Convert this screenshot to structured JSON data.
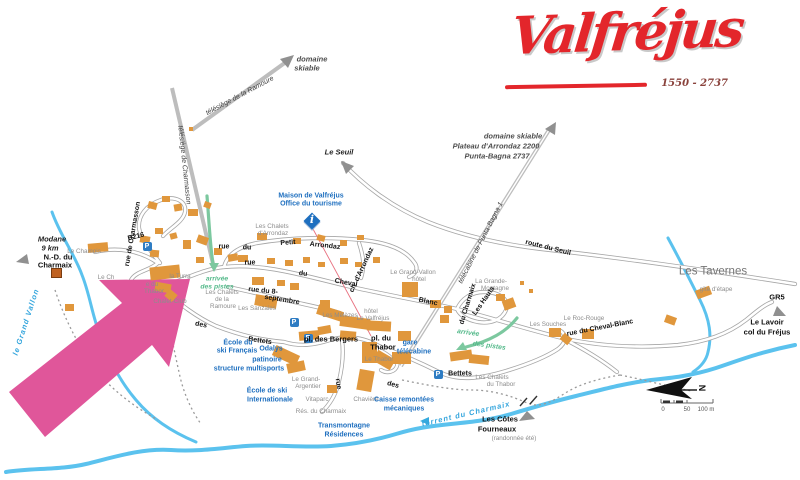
{
  "logo": {
    "name": "Valfréjus",
    "elevation": "1550 - 2737"
  },
  "icons": {
    "parking_letter": "P",
    "info_letter": "i"
  },
  "colors": {
    "highlight": "#e0569a",
    "building": "#e0973c",
    "river": "#5bc2ee",
    "road": "#a6a6a6",
    "lift": "#bdbdbd",
    "green": "#7cc89f",
    "brand": "#e3262b"
  },
  "highlight_arrow": {
    "points": "190,279 99,280 122,303 9,392 45,437 152,345 169,367"
  },
  "parkings": [
    {
      "x": 147,
      "y": 246
    },
    {
      "x": 294,
      "y": 322
    },
    {
      "x": 308,
      "y": 338
    },
    {
      "x": 438,
      "y": 374
    }
  ],
  "map_labels": [
    {
      "t": "télésiège de Charmasson",
      "x": 184,
      "y": 165,
      "cls": "lift",
      "r": 84
    },
    {
      "t": "télésiège de la Ramoure",
      "x": 240,
      "y": 96,
      "cls": "lift",
      "r": -28
    },
    {
      "t": "télécabine de Punta-Bagna 1",
      "x": 481,
      "y": 243,
      "cls": "lift",
      "r": -63
    },
    {
      "t": "domaine",
      "x": 312,
      "y": 59,
      "cls": "dom"
    },
    {
      "t": "skiable",
      "x": 307,
      "y": 68,
      "cls": "dom"
    },
    {
      "t": "domaine skiable",
      "x": 513,
      "y": 136,
      "cls": "dom"
    },
    {
      "t": "Plateau d'Arrondaz 2200",
      "x": 496,
      "y": 146,
      "cls": "dom"
    },
    {
      "t": "Punta-Bagna 2737",
      "x": 497,
      "y": 156,
      "cls": "dom"
    },
    {
      "t": "Le Seuil",
      "x": 339,
      "y": 152,
      "cls": "dest"
    },
    {
      "t": "Modane",
      "x": 52,
      "y": 239,
      "cls": "dest"
    },
    {
      "t": "9 km",
      "x": 50,
      "y": 248,
      "cls": "dest"
    },
    {
      "t": "N.-D. du",
      "x": 58,
      "y": 257,
      "cls": "pl"
    },
    {
      "t": "Charmaix",
      "x": 55,
      "y": 265,
      "cls": "pl"
    },
    {
      "t": "D216",
      "x": 136,
      "y": 237,
      "cls": "st",
      "r": -14
    },
    {
      "t": "rue de Charmasson",
      "x": 133,
      "y": 234,
      "cls": "st",
      "r": -80
    },
    {
      "t": "Le Chamois",
      "x": 84,
      "y": 252,
      "cls": "loc"
    },
    {
      "t": "le Grand Vallon",
      "x": 26,
      "y": 322,
      "cls": "riv",
      "r": -72
    },
    {
      "t": "Maison de Valfréjus",
      "x": 311,
      "y": 196,
      "cls": "bl"
    },
    {
      "t": "Office du tourisme",
      "x": 311,
      "y": 204,
      "cls": "bl"
    },
    {
      "t": "Les Chalets",
      "x": 272,
      "y": 227,
      "cls": "loc"
    },
    {
      "t": "d'Arrondaz",
      "x": 273,
      "y": 234,
      "cls": "loc"
    },
    {
      "t": "rue",
      "x": 224,
      "y": 247,
      "cls": "st"
    },
    {
      "t": "du",
      "x": 247,
      "y": 248,
      "cls": "st"
    },
    {
      "t": "Petit",
      "x": 288,
      "y": 243,
      "cls": "st",
      "r": -4
    },
    {
      "t": "Arrondaz",
      "x": 325,
      "y": 246,
      "cls": "st",
      "r": 6
    },
    {
      "t": "ch. d'Arrondaz",
      "x": 362,
      "y": 270,
      "cls": "st",
      "r": -65
    },
    {
      "t": "rue",
      "x": 250,
      "y": 263,
      "cls": "st"
    },
    {
      "t": "du",
      "x": 303,
      "y": 274,
      "cls": "st",
      "r": 6
    },
    {
      "t": "Cheval",
      "x": 346,
      "y": 283,
      "cls": "st",
      "r": 10
    },
    {
      "t": "Blanc",
      "x": 428,
      "y": 302,
      "cls": "st",
      "r": 12
    },
    {
      "t": "rue du 8-",
      "x": 263,
      "y": 291,
      "cls": "st",
      "r": 6
    },
    {
      "t": "septembre",
      "x": 282,
      "y": 300,
      "cls": "st",
      "r": 9
    },
    {
      "t": "Le Ch",
      "x": 106,
      "y": 278,
      "cls": "loc"
    },
    {
      "t": "la Turra",
      "x": 180,
      "y": 277,
      "cls": "loc"
    },
    {
      "t": "e du",
      "x": 152,
      "y": 285,
      "cls": "loc"
    },
    {
      "t": "Thabor",
      "x": 154,
      "y": 292,
      "cls": "loc"
    },
    {
      "t": "Chalet-Club",
      "x": 170,
      "y": 302,
      "cls": "loc"
    },
    {
      "t": "arrivée",
      "x": 217,
      "y": 280,
      "cls": "gr"
    },
    {
      "t": "des pistes",
      "x": 217,
      "y": 288,
      "cls": "gr"
    },
    {
      "t": "Les Chalets",
      "x": 222,
      "y": 293,
      "cls": "loc"
    },
    {
      "t": "de la",
      "x": 222,
      "y": 300,
      "cls": "loc"
    },
    {
      "t": "Ramoure",
      "x": 223,
      "y": 307,
      "cls": "loc"
    },
    {
      "t": "Les Sanzaies",
      "x": 257,
      "y": 309,
      "cls": "loc"
    },
    {
      "t": "des",
      "x": 201,
      "y": 325,
      "cls": "st",
      "r": 12
    },
    {
      "t": "Bettets",
      "x": 260,
      "y": 341,
      "cls": "st",
      "r": 8
    },
    {
      "t": "Les Mélèzes",
      "x": 340,
      "y": 316,
      "cls": "loc"
    },
    {
      "t": "hôtel",
      "x": 371,
      "y": 312,
      "cls": "loc"
    },
    {
      "t": "Le Valfréjus",
      "x": 373,
      "y": 319,
      "cls": "loc"
    },
    {
      "t": "Le Grand-Vallon",
      "x": 413,
      "y": 273,
      "cls": "loc"
    },
    {
      "t": "hôtel",
      "x": 419,
      "y": 280,
      "cls": "loc"
    },
    {
      "t": "La Grande-",
      "x": 491,
      "y": 282,
      "cls": "loc"
    },
    {
      "t": "Montagne",
      "x": 495,
      "y": 289,
      "cls": "loc"
    },
    {
      "t": "Les Hauts",
      "x": 484,
      "y": 301,
      "cls": "st",
      "r": -55
    },
    {
      "t": "du Charmaix",
      "x": 468,
      "y": 304,
      "cls": "st",
      "r": -73
    },
    {
      "t": "Les Souches",
      "x": 548,
      "y": 325,
      "cls": "loc"
    },
    {
      "t": "Le Roc-Rouge",
      "x": 584,
      "y": 319,
      "cls": "loc"
    },
    {
      "t": "rue du Cheval-Blanc",
      "x": 600,
      "y": 328,
      "cls": "st",
      "r": -11
    },
    {
      "t": "route du Seuil",
      "x": 548,
      "y": 248,
      "cls": "st",
      "r": 14
    },
    {
      "t": "Les Tavernes",
      "x": 713,
      "y": 272,
      "cls": "big"
    },
    {
      "t": "gîte d'étape",
      "x": 716,
      "y": 290,
      "cls": "loc"
    },
    {
      "t": "GR5",
      "x": 777,
      "y": 297,
      "cls": "pl"
    },
    {
      "t": "Le Lavoir",
      "x": 767,
      "y": 322,
      "cls": "pl"
    },
    {
      "t": "col du Fréjus",
      "x": 767,
      "y": 332,
      "cls": "pl"
    },
    {
      "t": "arrivée",
      "x": 468,
      "y": 334,
      "cls": "gr",
      "r": 8
    },
    {
      "t": "des pistes",
      "x": 489,
      "y": 347,
      "cls": "gr",
      "r": 8
    },
    {
      "t": "pl. des Bergers",
      "x": 331,
      "y": 339,
      "cls": "pl"
    },
    {
      "t": "pl. du",
      "x": 381,
      "y": 338,
      "cls": "pl"
    },
    {
      "t": "Thabor",
      "x": 383,
      "y": 347,
      "cls": "pl"
    },
    {
      "t": "Le Thabor",
      "x": 379,
      "y": 360,
      "cls": "loc"
    },
    {
      "t": "gare",
      "x": 410,
      "y": 343,
      "cls": "bl"
    },
    {
      "t": "télécabine",
      "x": 414,
      "y": 352,
      "cls": "bl"
    },
    {
      "t": "École du",
      "x": 238,
      "y": 343,
      "cls": "bl"
    },
    {
      "t": "ski Français",
      "x": 237,
      "y": 351,
      "cls": "bl"
    },
    {
      "t": "Odalys",
      "x": 271,
      "y": 349,
      "cls": "bl"
    },
    {
      "t": "patinoire",
      "x": 267,
      "y": 360,
      "cls": "bl"
    },
    {
      "t": "structure multisports",
      "x": 249,
      "y": 369,
      "cls": "bl"
    },
    {
      "t": "École de ski",
      "x": 267,
      "y": 391,
      "cls": "bl"
    },
    {
      "t": "Internationale",
      "x": 270,
      "y": 400,
      "cls": "bl"
    },
    {
      "t": "Le Grand-",
      "x": 306,
      "y": 380,
      "cls": "loc"
    },
    {
      "t": "Argentier",
      "x": 308,
      "y": 387,
      "cls": "loc"
    },
    {
      "t": "Vitaparc",
      "x": 317,
      "y": 400,
      "cls": "loc"
    },
    {
      "t": "Rés. du Charmaix",
      "x": 321,
      "y": 412,
      "cls": "loc"
    },
    {
      "t": "Chavière",
      "x": 366,
      "y": 400,
      "cls": "loc"
    },
    {
      "t": "rue",
      "x": 338,
      "y": 384,
      "cls": "st",
      "r": 80
    },
    {
      "t": "des",
      "x": 393,
      "y": 385,
      "cls": "st",
      "r": 15
    },
    {
      "t": "Bettets",
      "x": 460,
      "y": 374,
      "cls": "st"
    },
    {
      "t": "Les Chalets",
      "x": 492,
      "y": 378,
      "cls": "loc"
    },
    {
      "t": "du Thabor",
      "x": 501,
      "y": 385,
      "cls": "loc"
    },
    {
      "t": "Caisse remontées",
      "x": 404,
      "y": 400,
      "cls": "bl"
    },
    {
      "t": "mécaniques",
      "x": 404,
      "y": 409,
      "cls": "bl"
    },
    {
      "t": "Transmontagne",
      "x": 344,
      "y": 426,
      "cls": "bl"
    },
    {
      "t": "Résidences",
      "x": 344,
      "y": 435,
      "cls": "bl"
    },
    {
      "t": "torrent du Charmaix",
      "x": 466,
      "y": 414,
      "cls": "riv",
      "r": -13
    },
    {
      "t": "Les Côtes",
      "x": 500,
      "y": 419,
      "cls": "pl"
    },
    {
      "t": "Fourneaux",
      "x": 497,
      "y": 429,
      "cls": "pl"
    },
    {
      "t": "(randonnée été)",
      "x": 514,
      "y": 439,
      "cls": "loc"
    },
    {
      "t": "N",
      "x": 703,
      "y": 388,
      "cls": "cn",
      "r": -90
    },
    {
      "t": "0",
      "x": 663,
      "y": 410,
      "cls": "sc"
    },
    {
      "t": "50",
      "x": 687,
      "y": 410,
      "cls": "sc"
    },
    {
      "t": "100 m",
      "x": 706,
      "y": 410,
      "cls": "sc"
    }
  ],
  "buildings": [
    {
      "x": 148,
      "y": 202,
      "w": 9,
      "h": 7,
      "r": 15
    },
    {
      "x": 162,
      "y": 196,
      "w": 8,
      "h": 6
    },
    {
      "x": 174,
      "y": 204,
      "w": 8,
      "h": 7,
      "r": -10
    },
    {
      "x": 188,
      "y": 209,
      "w": 10,
      "h": 7
    },
    {
      "x": 204,
      "y": 202,
      "w": 7,
      "h": 6,
      "r": 20
    },
    {
      "x": 88,
      "y": 243,
      "w": 20,
      "h": 9,
      "r": -5
    },
    {
      "x": 140,
      "y": 236,
      "w": 10,
      "h": 7,
      "r": 10
    },
    {
      "x": 155,
      "y": 228,
      "w": 8,
      "h": 6
    },
    {
      "x": 170,
      "y": 233,
      "w": 7,
      "h": 6,
      "r": -15
    },
    {
      "x": 150,
      "y": 250,
      "w": 9,
      "h": 7,
      "r": 5
    },
    {
      "x": 183,
      "y": 240,
      "w": 8,
      "h": 9
    },
    {
      "x": 197,
      "y": 236,
      "w": 11,
      "h": 8,
      "r": 20
    },
    {
      "x": 214,
      "y": 248,
      "w": 8,
      "h": 7
    },
    {
      "x": 196,
      "y": 257,
      "w": 8,
      "h": 6
    },
    {
      "x": 228,
      "y": 254,
      "w": 10,
      "h": 7,
      "r": -10
    },
    {
      "x": 150,
      "y": 266,
      "w": 30,
      "h": 13,
      "r": -6
    },
    {
      "x": 155,
      "y": 283,
      "w": 16,
      "h": 9,
      "r": 10
    },
    {
      "x": 166,
      "y": 291,
      "w": 10,
      "h": 9,
      "r": 40
    },
    {
      "x": 189,
      "y": 127,
      "w": 4,
      "h": 4
    },
    {
      "x": 257,
      "y": 233,
      "w": 10,
      "h": 7
    },
    {
      "x": 293,
      "y": 238,
      "w": 8,
      "h": 6
    },
    {
      "x": 317,
      "y": 235,
      "w": 8,
      "h": 6,
      "r": 15
    },
    {
      "x": 340,
      "y": 240,
      "w": 7,
      "h": 6
    },
    {
      "x": 357,
      "y": 235,
      "w": 7,
      "h": 5
    },
    {
      "x": 238,
      "y": 255,
      "w": 10,
      "h": 7
    },
    {
      "x": 267,
      "y": 258,
      "w": 8,
      "h": 6
    },
    {
      "x": 285,
      "y": 260,
      "w": 8,
      "h": 6
    },
    {
      "x": 303,
      "y": 257,
      "w": 7,
      "h": 6
    },
    {
      "x": 318,
      "y": 262,
      "w": 7,
      "h": 5
    },
    {
      "x": 340,
      "y": 258,
      "w": 8,
      "h": 6
    },
    {
      "x": 355,
      "y": 262,
      "w": 7,
      "h": 5
    },
    {
      "x": 373,
      "y": 257,
      "w": 7,
      "h": 6
    },
    {
      "x": 252,
      "y": 277,
      "w": 12,
      "h": 8
    },
    {
      "x": 277,
      "y": 280,
      "w": 8,
      "h": 6
    },
    {
      "x": 290,
      "y": 283,
      "w": 9,
      "h": 7
    },
    {
      "x": 255,
      "y": 296,
      "w": 22,
      "h": 11,
      "r": 10
    },
    {
      "x": 320,
      "y": 300,
      "w": 10,
      "h": 8
    },
    {
      "x": 402,
      "y": 282,
      "w": 16,
      "h": 15
    },
    {
      "x": 430,
      "y": 300,
      "w": 11,
      "h": 8
    },
    {
      "x": 444,
      "y": 306,
      "w": 8,
      "h": 7
    },
    {
      "x": 440,
      "y": 315,
      "w": 9,
      "h": 8
    },
    {
      "x": 317,
      "y": 308,
      "w": 26,
      "h": 10,
      "r": 18
    },
    {
      "x": 340,
      "y": 317,
      "w": 30,
      "h": 11,
      "r": 8
    },
    {
      "x": 367,
      "y": 321,
      "w": 24,
      "h": 10,
      "r": 3
    },
    {
      "x": 299,
      "y": 331,
      "w": 20,
      "h": 9,
      "r": -5
    },
    {
      "x": 318,
      "y": 326,
      "w": 13,
      "h": 8,
      "r": -10
    },
    {
      "x": 340,
      "y": 331,
      "w": 16,
      "h": 9,
      "r": 5
    },
    {
      "x": 273,
      "y": 350,
      "w": 26,
      "h": 11,
      "r": 25
    },
    {
      "x": 287,
      "y": 362,
      "w": 18,
      "h": 10,
      "r": -12
    },
    {
      "x": 362,
      "y": 342,
      "w": 15,
      "h": 21
    },
    {
      "x": 374,
      "y": 354,
      "w": 20,
      "h": 12,
      "r": 30
    },
    {
      "x": 398,
      "y": 331,
      "w": 13,
      "h": 10
    },
    {
      "x": 392,
      "y": 352,
      "w": 19,
      "h": 12
    },
    {
      "x": 358,
      "y": 370,
      "w": 15,
      "h": 21,
      "r": 10
    },
    {
      "x": 327,
      "y": 385,
      "w": 10,
      "h": 8
    },
    {
      "x": 450,
      "y": 351,
      "w": 22,
      "h": 9,
      "r": -8
    },
    {
      "x": 469,
      "y": 355,
      "w": 20,
      "h": 9,
      "r": 6
    },
    {
      "x": 496,
      "y": 294,
      "w": 9,
      "h": 7
    },
    {
      "x": 503,
      "y": 299,
      "w": 12,
      "h": 10,
      "r": -20
    },
    {
      "x": 520,
      "y": 281,
      "w": 4,
      "h": 4
    },
    {
      "x": 529,
      "y": 289,
      "w": 4,
      "h": 4
    },
    {
      "x": 549,
      "y": 328,
      "w": 12,
      "h": 9
    },
    {
      "x": 561,
      "y": 335,
      "w": 10,
      "h": 8,
      "r": 40
    },
    {
      "x": 582,
      "y": 329,
      "w": 12,
      "h": 10
    },
    {
      "x": 696,
      "y": 288,
      "w": 15,
      "h": 9,
      "r": -20
    },
    {
      "x": 665,
      "y": 316,
      "w": 11,
      "h": 8,
      "r": 20
    },
    {
      "x": 65,
      "y": 304,
      "w": 9,
      "h": 7
    },
    {
      "x": 52,
      "y": 269,
      "w": 9,
      "h": 8,
      "c": "chapel"
    }
  ]
}
